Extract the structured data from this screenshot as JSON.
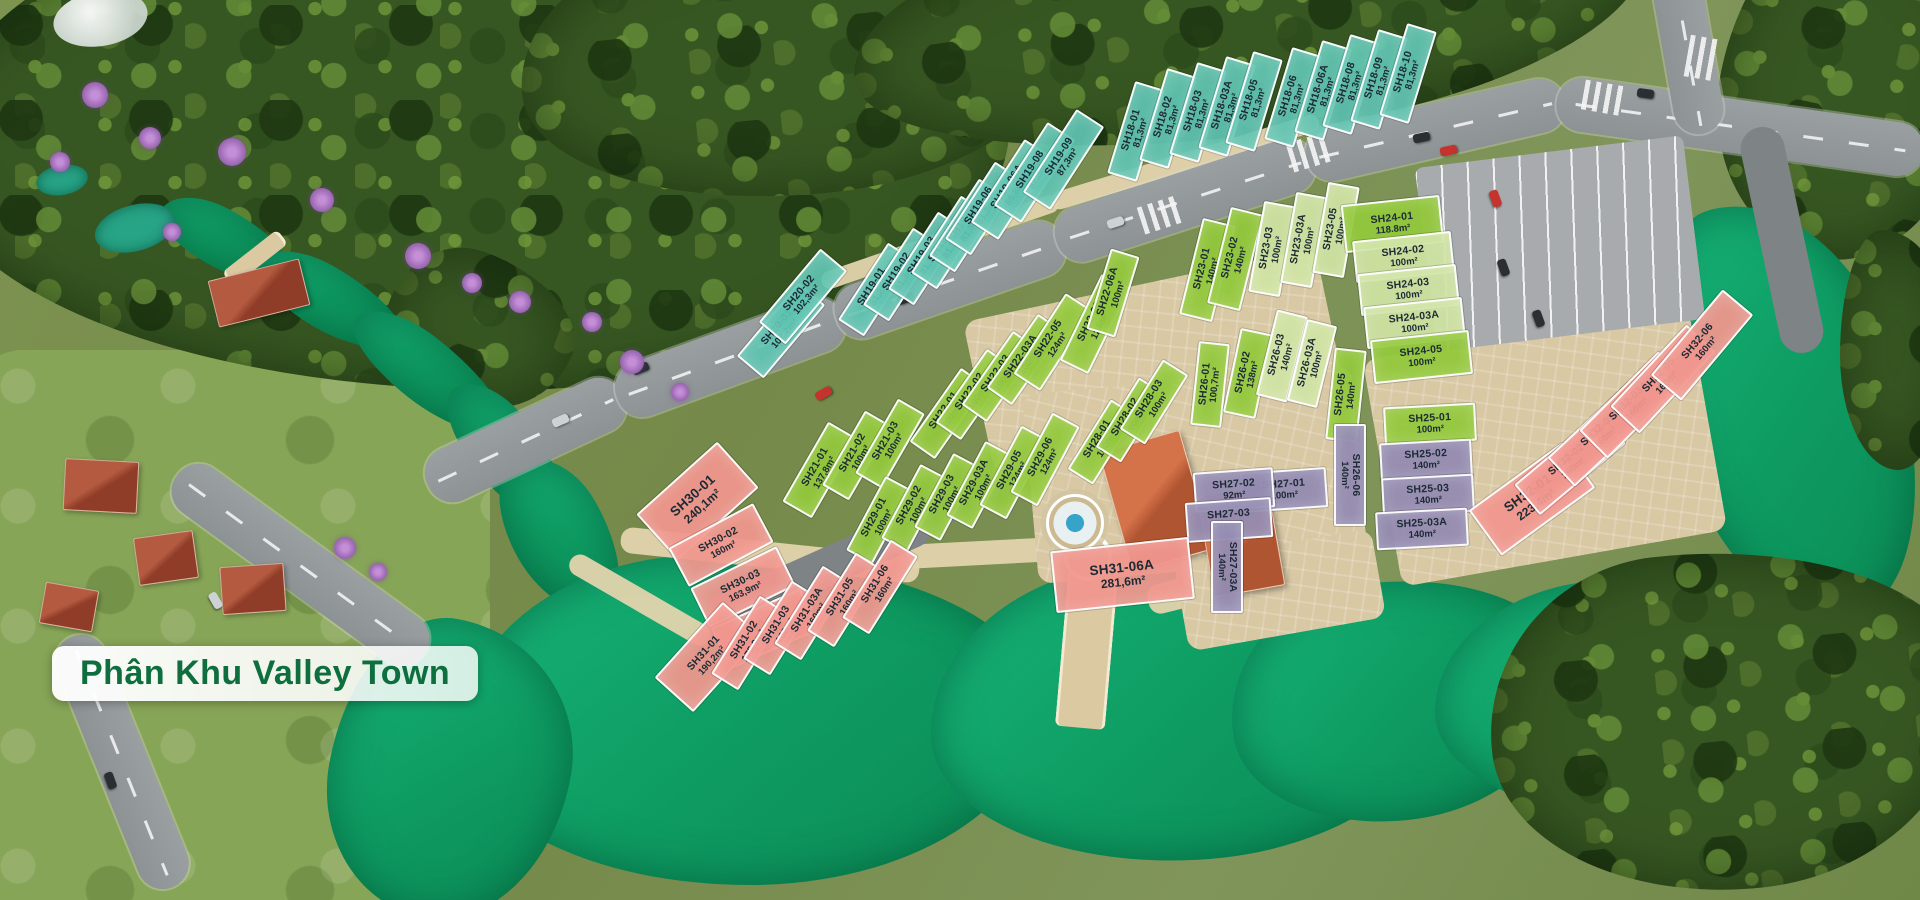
{
  "title": {
    "label": "Phân Khu Valley Town"
  },
  "palette": {
    "teal": "#5fc3b0",
    "green": "#93c83c",
    "pale_green": "#cfe3a2",
    "pink": "#f0968d",
    "purple": "#948bb1",
    "water": "#0f9e63",
    "road": "#96999b",
    "forest": "#35511e",
    "plaza": "#d8c8a4",
    "title_text": "#0e6e3e",
    "title_bg": "#ffffff",
    "lot_border": "#ffffff",
    "lot_text": "#1c2a35"
  },
  "lots": [
    {
      "id": "SH18-01",
      "area": "81,3m²",
      "x": 1134,
      "y": 129,
      "w": 92,
      "h": 27,
      "rot": -73,
      "color": "teal"
    },
    {
      "id": "SH18-02",
      "area": "81,3m²",
      "x": 1166,
      "y": 116,
      "w": 92,
      "h": 27,
      "rot": -73,
      "color": "teal"
    },
    {
      "id": "SH18-03",
      "area": "81,3m²",
      "x": 1196,
      "y": 110,
      "w": 92,
      "h": 27,
      "rot": -73,
      "color": "teal"
    },
    {
      "id": "SH18-03A",
      "area": "81,3m²",
      "x": 1225,
      "y": 104,
      "w": 92,
      "h": 27,
      "rot": -73,
      "color": "teal"
    },
    {
      "id": "SH18-05",
      "area": "81,3m²",
      "x": 1252,
      "y": 99,
      "w": 92,
      "h": 27,
      "rot": -73,
      "color": "teal"
    },
    {
      "id": "SH18-06",
      "area": "81,3m²",
      "x": 1291,
      "y": 95,
      "w": 92,
      "h": 27,
      "rot": -73,
      "color": "teal"
    },
    {
      "id": "SH18-06A",
      "area": "81,3m²",
      "x": 1321,
      "y": 88,
      "w": 92,
      "h": 27,
      "rot": -73,
      "color": "teal"
    },
    {
      "id": "SH18-08",
      "area": "81,3m²",
      "x": 1349,
      "y": 82,
      "w": 92,
      "h": 27,
      "rot": -73,
      "color": "teal"
    },
    {
      "id": "SH18-09",
      "area": "81,3m²",
      "x": 1377,
      "y": 77,
      "w": 92,
      "h": 27,
      "rot": -73,
      "color": "teal"
    },
    {
      "id": "SH18-10",
      "area": "81,3m²",
      "x": 1406,
      "y": 71,
      "w": 92,
      "h": 27,
      "rot": -73,
      "color": "teal"
    },
    {
      "id": "SH19-01",
      "area": "81,2m²",
      "x": 874,
      "y": 287,
      "w": 88,
      "h": 27,
      "rot": -57,
      "color": "teal"
    },
    {
      "id": "SH19-02",
      "area": "81,3m²",
      "x": 899,
      "y": 272,
      "w": 88,
      "h": 27,
      "rot": -57,
      "color": "teal"
    },
    {
      "id": "SH19-03",
      "area": "81,3m²",
      "x": 924,
      "y": 256,
      "w": 88,
      "h": 27,
      "rot": -57,
      "color": "teal"
    },
    {
      "id": "SH19-03A",
      "area": "81,3m²",
      "x": 947,
      "y": 240,
      "w": 88,
      "h": 27,
      "rot": -57,
      "color": "teal"
    },
    {
      "id": "SH19-05",
      "area": "81,3m²",
      "x": 965,
      "y": 223,
      "w": 88,
      "h": 27,
      "rot": -57,
      "color": "teal"
    },
    {
      "id": "SH19-06",
      "area": "81,3m²",
      "x": 981,
      "y": 206,
      "w": 88,
      "h": 27,
      "rot": -57,
      "color": "teal"
    },
    {
      "id": "SH19-06A",
      "area": "85,8m²",
      "x": 1009,
      "y": 187,
      "w": 95,
      "h": 29,
      "rot": -57,
      "color": "teal"
    },
    {
      "id": "SH19-08",
      "area": "87,3m²",
      "x": 1032,
      "y": 170,
      "w": 95,
      "h": 29,
      "rot": -57,
      "color": "teal"
    },
    {
      "id": "SH19-09",
      "area": "87,3m²",
      "x": 1061,
      "y": 157,
      "w": 95,
      "h": 29,
      "rot": -57,
      "color": "teal"
    },
    {
      "id": "SH20-01",
      "area": "102,2m²",
      "x": 779,
      "y": 328,
      "w": 92,
      "h": 31,
      "rot": -50,
      "color": "teal"
    },
    {
      "id": "SH20-02",
      "area": "102,3m²",
      "x": 801,
      "y": 294,
      "w": 92,
      "h": 31,
      "rot": -50,
      "color": "teal"
    },
    {
      "id": "SH21-01",
      "area": "137,8m²",
      "x": 818,
      "y": 468,
      "w": 88,
      "h": 30,
      "rot": -60,
      "color": "green"
    },
    {
      "id": "SH21-02",
      "area": "100m²",
      "x": 855,
      "y": 453,
      "w": 82,
      "h": 27,
      "rot": -60,
      "color": "green"
    },
    {
      "id": "SH21-03",
      "area": "100m²",
      "x": 888,
      "y": 441,
      "w": 82,
      "h": 27,
      "rot": -60,
      "color": "green"
    },
    {
      "id": "SH22-01",
      "area": "100m²",
      "x": 946,
      "y": 411,
      "w": 86,
      "h": 27,
      "rot": -55,
      "color": "green"
    },
    {
      "id": "SH22-02",
      "area": "100m²",
      "x": 972,
      "y": 392,
      "w": 86,
      "h": 27,
      "rot": -55,
      "color": "green"
    },
    {
      "id": "SH22-03",
      "area": "100m²",
      "x": 998,
      "y": 374,
      "w": 86,
      "h": 27,
      "rot": -55,
      "color": "green"
    },
    {
      "id": "SH22-03A",
      "area": "100m²",
      "x": 1023,
      "y": 357,
      "w": 86,
      "h": 27,
      "rot": -55,
      "color": "green"
    },
    {
      "id": "SH22-05",
      "area": "124m²",
      "x": 1051,
      "y": 340,
      "w": 92,
      "h": 28,
      "rot": -57,
      "color": "green"
    },
    {
      "id": "SH22-06",
      "area": "124m²",
      "x": 1093,
      "y": 322,
      "w": 92,
      "h": 28,
      "rot": -64,
      "color": "green"
    },
    {
      "id": "SH22-06A",
      "area": "100m²",
      "x": 1111,
      "y": 291,
      "w": 80,
      "h": 26,
      "rot": -73,
      "color": "green"
    },
    {
      "id": "SH23-01",
      "area": "140m²",
      "x": 1205,
      "y": 268,
      "w": 95,
      "h": 30,
      "rot": -76,
      "color": "green"
    },
    {
      "id": "SH23-02",
      "area": "140m²",
      "x": 1233,
      "y": 257,
      "w": 95,
      "h": 30,
      "rot": -76,
      "color": "green"
    },
    {
      "id": "SH23-03",
      "area": "100m²",
      "x": 1270,
      "y": 247,
      "w": 88,
      "h": 28,
      "rot": -80,
      "color": "pale"
    },
    {
      "id": "SH23-03A",
      "area": "100m²",
      "x": 1302,
      "y": 238,
      "w": 88,
      "h": 28,
      "rot": -80,
      "color": "pale"
    },
    {
      "id": "SH23-05",
      "area": "100m²",
      "x": 1334,
      "y": 228,
      "w": 88,
      "h": 28,
      "rot": -80,
      "color": "pale"
    },
    {
      "id": "SH24-01",
      "area": "118.8m²",
      "x": 1390,
      "y": 222,
      "w": 95,
      "h": 44,
      "rot": -6,
      "color": "green"
    },
    {
      "id": "SH24-02",
      "area": "100m²",
      "x": 1401,
      "y": 255,
      "w": 95,
      "h": 38,
      "rot": -6,
      "color": "pale"
    },
    {
      "id": "SH24-03",
      "area": "100m²",
      "x": 1406,
      "y": 288,
      "w": 95,
      "h": 38,
      "rot": -6,
      "color": "pale"
    },
    {
      "id": "SH24-03A",
      "area": "100m²",
      "x": 1412,
      "y": 321,
      "w": 95,
      "h": 38,
      "rot": -6,
      "color": "pale"
    },
    {
      "id": "SH24-05",
      "area": "100m²",
      "x": 1419,
      "y": 355,
      "w": 95,
      "h": 40,
      "rot": -6,
      "color": "green"
    },
    {
      "id": "SH25-01",
      "area": "100m²",
      "x": 1428,
      "y": 422,
      "w": 88,
      "h": 34,
      "rot": -3,
      "color": "green"
    },
    {
      "id": "SH25-02",
      "area": "140m²",
      "x": 1424,
      "y": 458,
      "w": 88,
      "h": 34,
      "rot": -3,
      "color": "purple"
    },
    {
      "id": "SH25-03",
      "area": "140m²",
      "x": 1426,
      "y": 493,
      "w": 88,
      "h": 34,
      "rot": -3,
      "color": "purple"
    },
    {
      "id": "SH25-03A",
      "area": "140m²",
      "x": 1420,
      "y": 527,
      "w": 88,
      "h": 34,
      "rot": -3,
      "color": "purple"
    },
    {
      "id": "SH26-01",
      "area": "100,7m²",
      "x": 1208,
      "y": 382,
      "w": 80,
      "h": 27,
      "rot": -84,
      "color": "green"
    },
    {
      "id": "SH26-02",
      "area": "138m²",
      "x": 1246,
      "y": 371,
      "w": 82,
      "h": 29,
      "rot": -78,
      "color": "green"
    },
    {
      "id": "SH26-03",
      "area": "140m²",
      "x": 1280,
      "y": 354,
      "w": 84,
      "h": 28,
      "rot": -76,
      "color": "pale"
    },
    {
      "id": "SH26-03A",
      "area": "100m²",
      "x": 1310,
      "y": 361,
      "w": 80,
      "h": 27,
      "rot": -76,
      "color": "pale"
    },
    {
      "id": "SH26-05",
      "area": "140m²",
      "x": 1344,
      "y": 393,
      "w": 88,
      "h": 28,
      "rot": -84,
      "color": "green"
    },
    {
      "id": "SH26-06",
      "area": "140m²",
      "x": 1348,
      "y": 473,
      "w": 98,
      "h": 28,
      "rot": 90,
      "color": "purple"
    },
    {
      "id": "SH27-01",
      "area": "100m²",
      "x": 1282,
      "y": 488,
      "w": 82,
      "h": 36,
      "rot": -4,
      "color": "purple"
    },
    {
      "id": "SH27-02",
      "area": "92m²",
      "x": 1232,
      "y": 488,
      "w": 76,
      "h": 36,
      "rot": -4,
      "color": "purple"
    },
    {
      "id": "SH27-03",
      "area": "100m²",
      "x": 1227,
      "y": 518,
      "w": 82,
      "h": 36,
      "rot": -4,
      "color": "purple"
    },
    {
      "id": "SH27-03A",
      "area": "140m²",
      "x": 1225,
      "y": 565,
      "w": 88,
      "h": 28,
      "rot": 90,
      "color": "purple"
    },
    {
      "id": "SH28-01",
      "area": "100m²",
      "x": 1100,
      "y": 440,
      "w": 78,
      "h": 26,
      "rot": -58,
      "color": "green"
    },
    {
      "id": "SH28-02",
      "area": "100m²",
      "x": 1128,
      "y": 418,
      "w": 78,
      "h": 26,
      "rot": -58,
      "color": "green"
    },
    {
      "id": "SH28-03",
      "area": "100m²",
      "x": 1152,
      "y": 400,
      "w": 78,
      "h": 26,
      "rot": -58,
      "color": "green"
    },
    {
      "id": "SH29-01",
      "area": "100m²",
      "x": 877,
      "y": 518,
      "w": 80,
      "h": 26,
      "rot": -62,
      "color": "green"
    },
    {
      "id": "SH29-02",
      "area": "100m²",
      "x": 912,
      "y": 506,
      "w": 80,
      "h": 26,
      "rot": -62,
      "color": "green"
    },
    {
      "id": "SH29-03",
      "area": "100m²",
      "x": 945,
      "y": 495,
      "w": 80,
      "h": 26,
      "rot": -62,
      "color": "green"
    },
    {
      "id": "SH29-03A",
      "area": "100m²",
      "x": 977,
      "y": 483,
      "w": 80,
      "h": 26,
      "rot": -62,
      "color": "green"
    },
    {
      "id": "SH29-05",
      "area": "124m²",
      "x": 1012,
      "y": 470,
      "w": 86,
      "h": 27,
      "rot": -62,
      "color": "green"
    },
    {
      "id": "SH29-06",
      "area": "124m²",
      "x": 1043,
      "y": 457,
      "w": 86,
      "h": 27,
      "rot": -62,
      "color": "green"
    },
    {
      "id": "SH30-01",
      "area": "240,1m²",
      "x": 695,
      "y": 499,
      "w": 105,
      "h": 58,
      "rot": -42,
      "color": "pink",
      "big": true
    },
    {
      "id": "SH30-02",
      "area": "160m²",
      "x": 719,
      "y": 543,
      "w": 92,
      "h": 40,
      "rot": -28,
      "color": "pink"
    },
    {
      "id": "SH30-03",
      "area": "163,9m²",
      "x": 741,
      "y": 585,
      "w": 92,
      "h": 40,
      "rot": -26,
      "color": "pink"
    },
    {
      "id": "SH30-03A",
      "area": "183,2m²",
      "x": 763,
      "y": 627,
      "w": 94,
      "h": 42,
      "rot": -24,
      "color": "pink"
    },
    {
      "id": "SH31-01",
      "area": "190,2m²",
      "x": 706,
      "y": 655,
      "w": 98,
      "h": 48,
      "rot": -48,
      "color": "pink"
    },
    {
      "id": "SH31-02",
      "area": "175,9m²",
      "x": 747,
      "y": 641,
      "w": 88,
      "h": 28,
      "rot": -58,
      "color": "pink"
    },
    {
      "id": "SH31-03",
      "area": "160m²",
      "x": 779,
      "y": 626,
      "w": 88,
      "h": 28,
      "rot": -58,
      "color": "pink"
    },
    {
      "id": "SH31-03A",
      "area": "160m²",
      "x": 810,
      "y": 611,
      "w": 88,
      "h": 28,
      "rot": -58,
      "color": "pink"
    },
    {
      "id": "SH31-05",
      "area": "160m²",
      "x": 843,
      "y": 598,
      "w": 88,
      "h": 28,
      "rot": -58,
      "color": "pink"
    },
    {
      "id": "SH31-06",
      "area": "160m²",
      "x": 878,
      "y": 585,
      "w": 88,
      "h": 28,
      "rot": -58,
      "color": "pink"
    },
    {
      "id": "SH31-06A",
      "area": "281,6m²",
      "x": 1120,
      "y": 573,
      "w": 135,
      "h": 58,
      "rot": -6,
      "color": "pink",
      "big": true
    },
    {
      "id": "SH32-01",
      "area": "223,4m²",
      "x": 1530,
      "y": 497,
      "w": 112,
      "h": 52,
      "rot": -36,
      "color": "pink",
      "big": true
    },
    {
      "id": "SH32-02",
      "area": "160m²",
      "x": 1568,
      "y": 462,
      "w": 108,
      "h": 36,
      "rot": -40,
      "color": "pink"
    },
    {
      "id": "SH32-03",
      "area": "160m²",
      "x": 1600,
      "y": 432,
      "w": 108,
      "h": 36,
      "rot": -43,
      "color": "pink"
    },
    {
      "id": "SH32-03A",
      "area": "160m²",
      "x": 1631,
      "y": 403,
      "w": 108,
      "h": 36,
      "rot": -45,
      "color": "pink"
    },
    {
      "id": "SH32-05",
      "area": "160m²",
      "x": 1661,
      "y": 377,
      "w": 108,
      "h": 36,
      "rot": -47,
      "color": "pink"
    },
    {
      "id": "SH32-06",
      "area": "160m²",
      "x": 1700,
      "y": 343,
      "w": 108,
      "h": 36,
      "rot": -50,
      "color": "pink"
    }
  ]
}
